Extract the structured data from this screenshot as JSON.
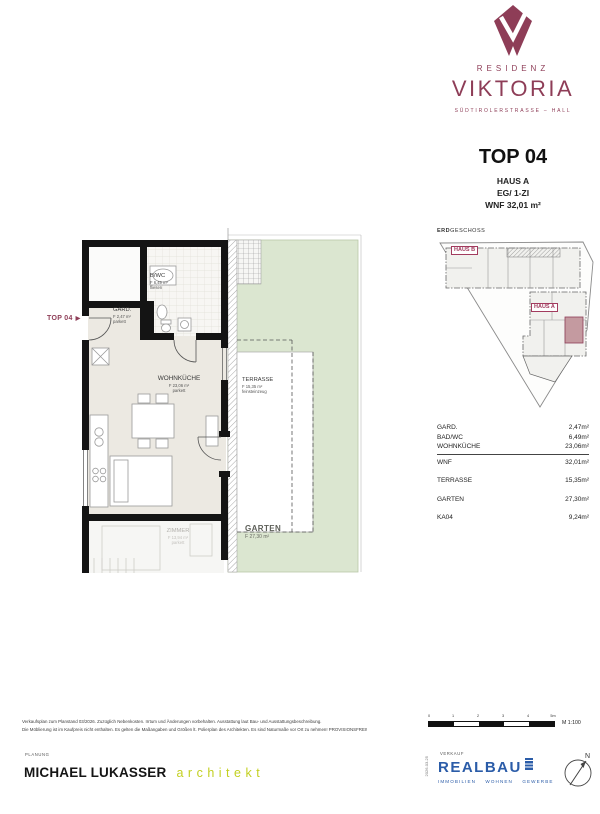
{
  "brand": {
    "residenz": "RESIDENZ",
    "viktoria": "VIKTORIA",
    "tagline": "SÜDTIROLERSTRASSE – HALL"
  },
  "unit": {
    "top": "TOP 04",
    "haus": "HAUS A",
    "type": "EG/ 1-ZI",
    "wnf": "WNF 32,01 m²"
  },
  "siteplan": {
    "title_bold": "ERD",
    "title_rest": "GESCHOSS",
    "haus_b": "HAUS B",
    "haus_a": "HAUS A"
  },
  "floorplan": {
    "entrance_label": "TOP 04",
    "rooms": {
      "bwc": {
        "name": "B/WC",
        "area": "F 6,49 m²",
        "finish": "fliesen"
      },
      "gard": {
        "name": "GARD.",
        "area": "F 2,47 m²",
        "finish": "parkett"
      },
      "wohnkueche": {
        "name": "WOHNKÜCHE",
        "area": "F 23,06 m²",
        "finish": "parkett"
      },
      "terrasse": {
        "name": "TERRASSE",
        "area": "F 15,35 m²",
        "finish": "feinsteinzeug"
      },
      "garten": {
        "name": "GARTEN",
        "area": "F 27,30 m²"
      },
      "zimmer": {
        "name": "ZIMMER",
        "area": "F 13,94 m²",
        "finish": "parkett"
      }
    }
  },
  "areas": {
    "rows": [
      {
        "label": "GARD.",
        "value": "2,47m²"
      },
      {
        "label": "BAD/WC",
        "value": "6,49m²"
      },
      {
        "label": "WOHNKÜCHE",
        "value": "23,06m²"
      },
      {
        "label": "WNF",
        "value": "32,01m²"
      },
      {
        "label": "TERRASSE",
        "value": "15,35m²"
      },
      {
        "label": "GARTEN",
        "value": "27,30m²"
      },
      {
        "label": "KA04",
        "value": "9,24m²"
      }
    ]
  },
  "scalebar": {
    "ticks": [
      "0",
      "1",
      "2",
      "3",
      "4",
      "5m"
    ],
    "scale": "M 1:100"
  },
  "footer": {
    "disclaimer1": "Verkaufsplan zum Planstand 03/2026. Zuzüglich Nebenkosten. Irrtum und Änderungen vorbehalten. Ausstattung laut Bau- und Ausstattungsbeschreibung.",
    "disclaimer2": "Die Möblierung ist im Kaufpreis nicht enthalten. Es gelten die Maßangaben und Größen lt. Polierplan des Architekten. Es sind Naturmaße vor Ort zu nehmen! PROVISIONSFREI!",
    "planung_label": "PLANUNG",
    "architect": "MICHAEL LUKASSER",
    "architect_title": "architekt",
    "verkauf_label": "VERKAUF",
    "realbau": "REALBAU",
    "realbau_sub": "IMMOBILIEN WOHNEN GEWERBE",
    "plan_date": "2026-03-25",
    "compass_n": "N"
  },
  "colors": {
    "brand": "#8e3d57",
    "site_highlight": "#c49aa0",
    "architekt_green": "#c3d021",
    "realbau_blue": "#2b5ca8",
    "garden_green": "#dbe6d0"
  }
}
